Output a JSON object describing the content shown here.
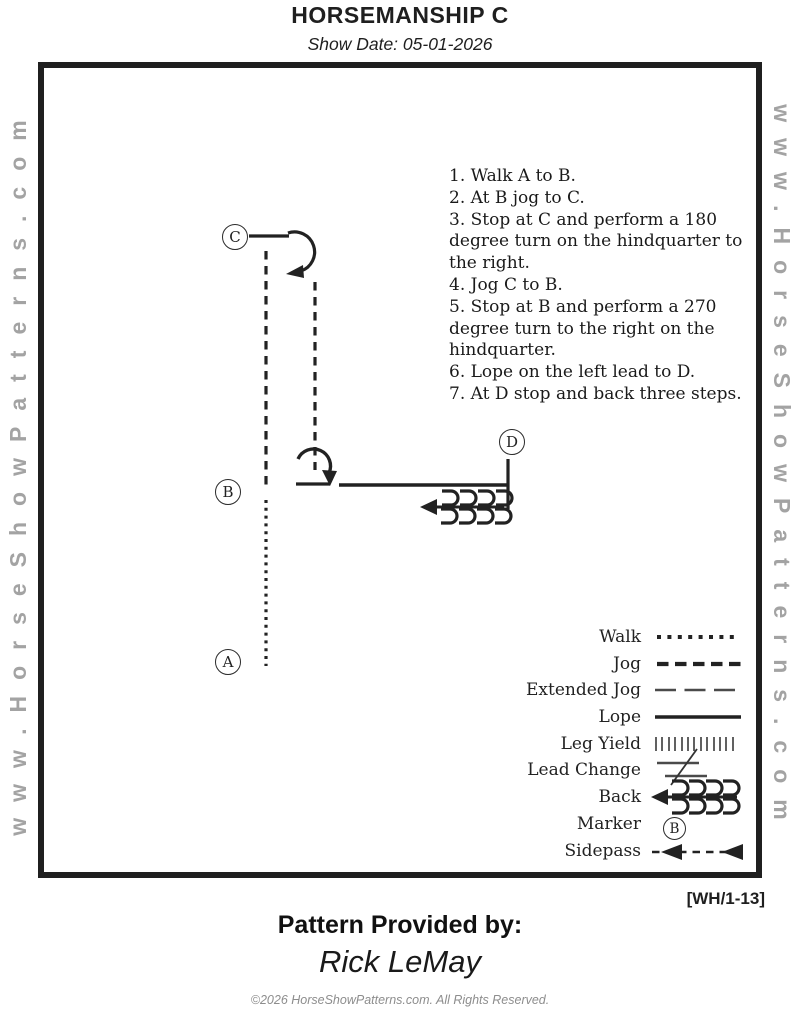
{
  "page": {
    "title": "HORSEMANSHIP C",
    "show_date": "Show Date: 05-01-2026",
    "watermark": "www.HorseShowPatterns.com",
    "pattern_code": "[WH/1-13]",
    "provided_by_label": "Pattern Provided by:",
    "provider_name": "Rick LeMay",
    "copyright": "©2026 HorseShowPatterns.com. All Rights Reserved."
  },
  "instructions": [
    "1. Walk A to B.",
    "2. At B jog to C.",
    "3. Stop at C and perform a 180 degree turn on the hindquarter to the right.",
    "4. Jog C to B.",
    "5. Stop at B and perform a 270 degree turn to the right on the hindquarter.",
    "6. Lope on the left lead to D.",
    "7. At D stop and back three steps."
  ],
  "markers": {
    "a": "A",
    "b": "B",
    "c": "C",
    "d": "D"
  },
  "legend": {
    "items": [
      {
        "label": "Walk",
        "style": "dotted-line"
      },
      {
        "label": "Jog",
        "style": "dashed-line"
      },
      {
        "label": "Extended Jog",
        "style": "long-dash-line"
      },
      {
        "label": "Lope",
        "style": "solid-line"
      },
      {
        "label": "Leg Yield",
        "style": "tick-row"
      },
      {
        "label": "Lead Change",
        "style": "crossed-lines"
      },
      {
        "label": "Back",
        "style": "back-arrow"
      },
      {
        "label": "Marker",
        "style": "circled-letter",
        "letter": "B"
      },
      {
        "label": "Sidepass",
        "style": "dashed-arrow-line"
      }
    ]
  },
  "colors": {
    "ink": "#1f1f1f",
    "diagram_gray": "#4a4a4a",
    "watermark_gray": "#a3a3a3",
    "copyright_gray": "#8d8d8d"
  }
}
